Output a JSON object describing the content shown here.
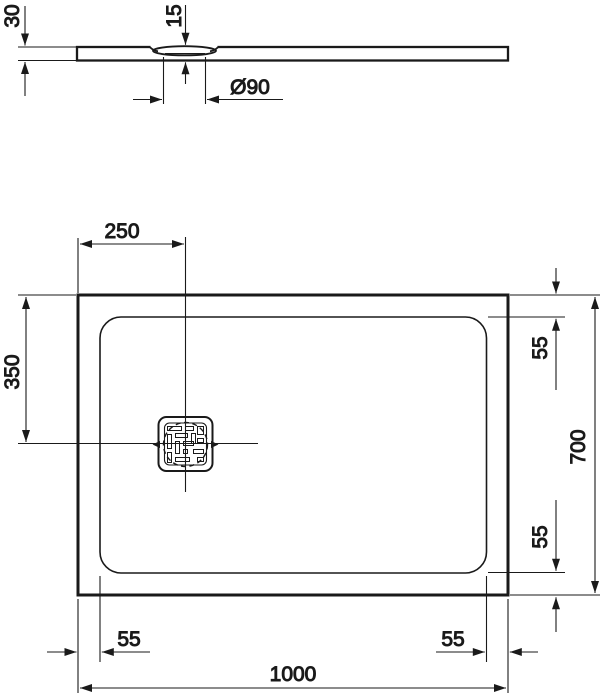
{
  "drawing_type": "shower-tray-technical-drawing",
  "colors": {
    "line": "#1a1a1a",
    "background": "#ffffff"
  },
  "profile_view": {
    "height_label": "30",
    "drain_depth_label": "15",
    "drain_diameter_label": "Ø90"
  },
  "plan_view": {
    "drain_offset_horizontal_label": "250",
    "drain_offset_vertical_label": "350",
    "edge_top_right_label": "55",
    "edge_bottom_right_label": "55",
    "edge_bottom_left_label": "55",
    "edge_bottom_far_right_label": "55",
    "depth_label": "700",
    "width_label": "1000"
  }
}
